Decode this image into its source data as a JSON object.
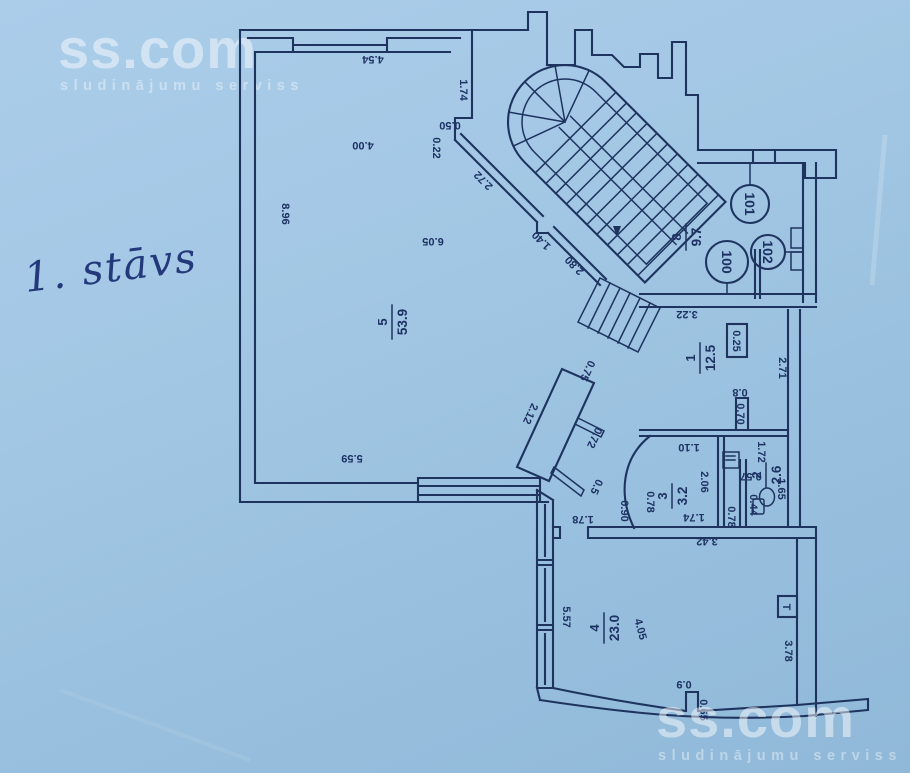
{
  "source": {
    "logo": "ss.com",
    "tagline": "sludinājumu serviss"
  },
  "annotation": {
    "floor_note": "1. stāvs"
  },
  "plan": {
    "rooms": {
      "r5": {
        "num": "5",
        "area": "53.9"
      },
      "r1": {
        "num": "1",
        "area": "12.5"
      },
      "r2": {
        "num": "2",
        "area": "2.6"
      },
      "r3": {
        "num": "3",
        "area": "3.2"
      },
      "r4": {
        "num": "4",
        "area": "23.0"
      },
      "r8": {
        "num": "8",
        "area": "9.7"
      }
    },
    "door_numbers": {
      "a": "101",
      "b": "100",
      "c": "102"
    },
    "shaft": "0.25",
    "marker_t": "T",
    "dims": {
      "d454": "4.54",
      "d174a": "1.74",
      "d050": "0.50",
      "d022": "0.22",
      "d400": "4.00",
      "d896": "8.96",
      "d605": "6.05",
      "d272": "2.72",
      "d140": "1.40",
      "d280": "2.80",
      "d559": "5.59",
      "d212": "2.12",
      "d075": "0.75",
      "d072": "0.72",
      "d05": "0.5",
      "d178": "1.78",
      "d322": "3.22",
      "d271": "2.71",
      "d070": "0.70",
      "d08": "0.8",
      "d172": "1.72",
      "d110": "1.10",
      "d206": "2.06",
      "d078a": "0.78",
      "d090": "0.90",
      "d174b": "1.74",
      "d342": "3.42",
      "d057": "0.57",
      "d044": "0.44",
      "d078b": "0.78",
      "d165": "1.65",
      "d557": "5.57",
      "d405": "4.05",
      "d378": "3.78",
      "d09": "0.9",
      "d065": "0.65"
    },
    "colors": {
      "paper": "#9fc4e1",
      "ink": "#1e345f",
      "watermark": "#ffffff"
    }
  }
}
